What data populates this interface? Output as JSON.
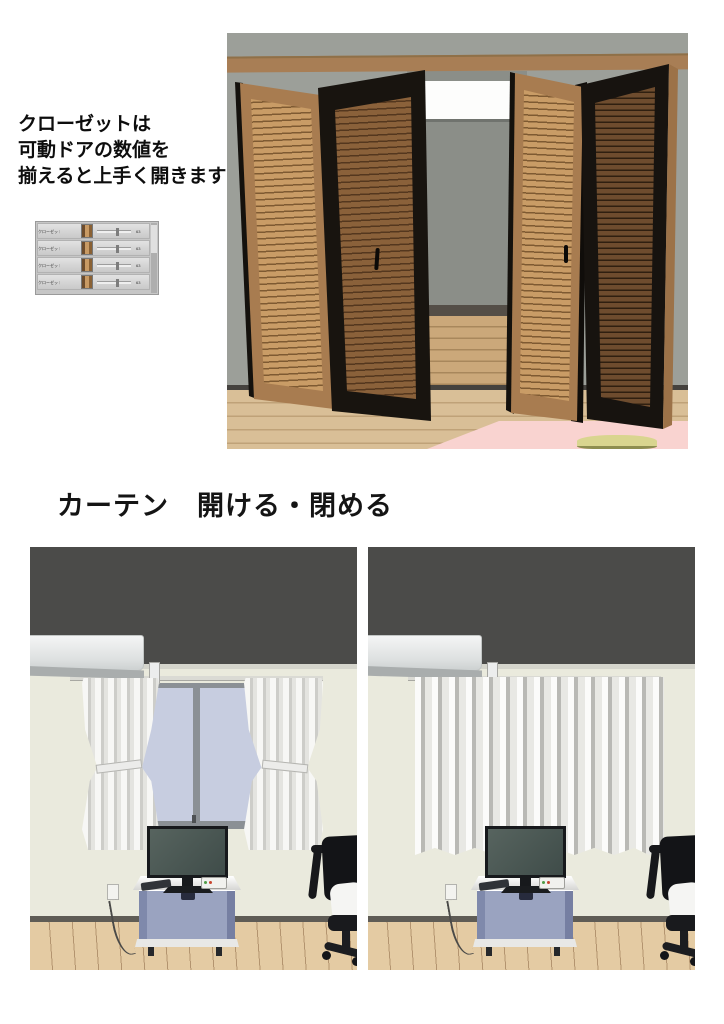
{
  "closet_section": {
    "caption_lines": [
      "クローゼットは",
      "可動ドアの数値を",
      "揃えると上手く開きます"
    ],
    "slider_panel": {
      "rows": [
        {
          "label": "クローゼットドア左端",
          "value": "63"
        },
        {
          "label": "クローゼットドア左",
          "value": "63"
        },
        {
          "label": "クローゼットドア右端",
          "value": "63"
        },
        {
          "label": "クローゼットドア右",
          "value": "63"
        }
      ]
    }
  },
  "curtain_section": {
    "heading": "カーテン　開ける・閉める"
  },
  "colors": {
    "closet_wall_gray": "#9c9f99",
    "door_light_brown": "#a87c50",
    "door_dark_frame": "#18140f",
    "rug_pink": "#f9d3d0",
    "room_wall_beige": "#eaeadd",
    "room_band_dark": "#4b4b49",
    "cart_blue": "#9aa3c0",
    "curtain_white": "#e8e8e4"
  }
}
